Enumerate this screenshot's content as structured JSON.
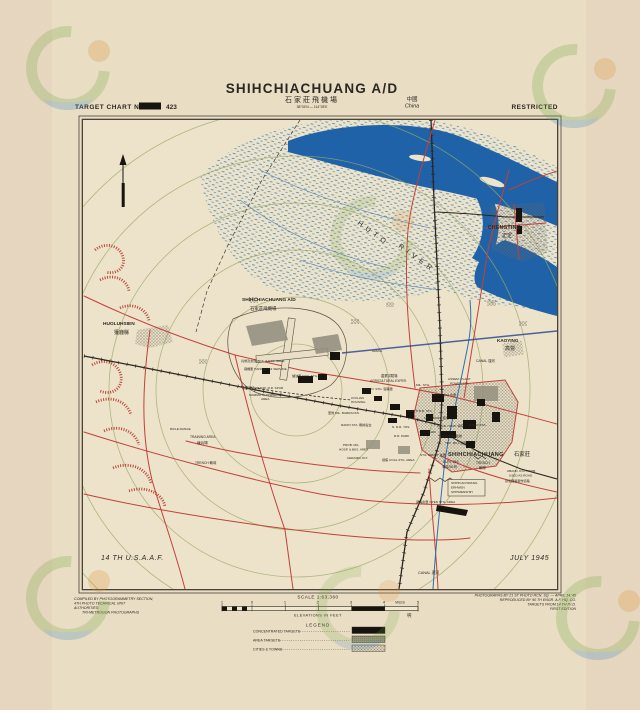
{
  "header": {
    "chart_label": "TARGET CHART No.",
    "chart_no": "423",
    "title": "SHIHCHIACHUANG A/D",
    "title_cn": "石家莊飛機場",
    "coords": "38°04'N — 114°28'E",
    "country_cn": "中國",
    "country": "China",
    "classification": "RESTRICTED"
  },
  "map": {
    "labels": [
      {
        "n": "huto-river-label-1",
        "t": "HUTO",
        "x": 357,
        "y": 224,
        "s": 7,
        "r": 36,
        "sp": 4.5
      },
      {
        "n": "huto-river-label-2",
        "t": "RIVER",
        "x": 398,
        "y": 247,
        "s": 7,
        "r": 36,
        "sp": 4.5
      },
      {
        "n": "chengting-label",
        "t": "CHENGTING",
        "x": 488,
        "y": 229,
        "s": 5,
        "b": 1,
        "sp": 0.3
      },
      {
        "n": "chengting-label-cn",
        "t": "正定",
        "x": 502,
        "y": 237,
        "s": 5
      },
      {
        "n": "kaoying-label",
        "t": "KAOYING",
        "x": 497,
        "y": 342,
        "s": 4.6,
        "b": 1
      },
      {
        "n": "kaoying-label-cn",
        "t": "高營",
        "x": 505,
        "y": 350,
        "s": 5
      },
      {
        "n": "canal-label-upper",
        "t": "CANAL 運河",
        "x": 476,
        "y": 362,
        "s": 3.4
      },
      {
        "n": "huoluhsien-label",
        "t": "HUOLUHSIEN",
        "x": 103,
        "y": 325,
        "s": 4.8,
        "b": 1
      },
      {
        "n": "huoluhsien-label-cn",
        "t": "獲鹿縣",
        "x": 114,
        "y": 334,
        "s": 5
      },
      {
        "n": "airfield-label",
        "t": "SHIHCHIACHUANG A/D",
        "x": 242,
        "y": 301,
        "s": 4.8,
        "b": 1
      },
      {
        "n": "airfield-label-cn",
        "t": "石家莊飛機場",
        "x": 250,
        "y": 310,
        "s": 4.4
      },
      {
        "n": "city-label",
        "t": "SHIHCHIACHUANG",
        "x": 448,
        "y": 456,
        "s": 5.6,
        "b": 1,
        "sp": 0.3
      },
      {
        "n": "city-label-cn",
        "t": "石家莊",
        "x": 514,
        "y": 456,
        "s": 5.4
      },
      {
        "t": "ELEV. 251'",
        "x": 443,
        "y": 463,
        "s": 3.3
      },
      {
        "t": "海拔251呎",
        "x": 442,
        "y": 468,
        "s": 3.2
      },
      {
        "t": "TRENCH",
        "x": 476,
        "y": 464,
        "s": 3.3
      },
      {
        "t": "戰壕",
        "x": 479,
        "y": 469,
        "s": 3.4
      },
      {
        "n": "usaaf-credit",
        "t": "14 TH U.S.A.A.F.",
        "x": 101,
        "y": 560,
        "s": 7,
        "i": 1,
        "sp": 0.6
      },
      {
        "n": "map-date",
        "t": "JULY 1945",
        "x": 510,
        "y": 560,
        "s": 7,
        "i": 1,
        "sp": 0.6
      },
      {
        "t": "農業試驗場",
        "x": 381,
        "y": 377,
        "s": 3.3
      },
      {
        "t": "AGRICULTURAL EXPER.",
        "x": 370,
        "y": 382,
        "s": 3.2
      },
      {
        "t": "AMMO. STG. 彈藥庫",
        "x": 364,
        "y": 390,
        "s": 3.1
      },
      {
        "t": "CIVILIAN",
        "x": 351,
        "y": 399,
        "s": 3.1
      },
      {
        "t": "HOUSING",
        "x": 351,
        "y": 403,
        "s": 3.1
      },
      {
        "t": "MIL. STG.",
        "x": 416,
        "y": 386,
        "s": 3.1
      },
      {
        "t": "ASSEM. PLANT",
        "x": 448,
        "y": 380,
        "s": 3.1
      },
      {
        "t": "POWER STA.",
        "x": 450,
        "y": 384.5,
        "s": 3.1
      },
      {
        "t": "STG. AREA 倉庫",
        "x": 433,
        "y": 396,
        "s": 3.1
      },
      {
        "t": "軍營 MIL. BARRACKS",
        "x": 328,
        "y": 414,
        "s": 3.1
      },
      {
        "t": "NORTH R.R. STA.",
        "x": 407,
        "y": 412,
        "s": 3.1
      },
      {
        "t": "RADIO STA. 無線電台",
        "x": 341,
        "y": 426,
        "s": 3.1
      },
      {
        "t": "MIL. ADMIN. 軍政",
        "x": 424,
        "y": 419,
        "s": 3.1
      },
      {
        "t": "兵營及倉庫 BKS. & STG. AREA",
        "x": 241,
        "y": 362,
        "s": 3.1
      },
      {
        "t": "飛機庫 HANGERS & SERVICE",
        "x": 244,
        "y": 370,
        "s": 3.1
      },
      {
        "t": "儲油庫 FUEL STG.",
        "x": 292,
        "y": 377,
        "s": 3.1
      },
      {
        "t": "廢棄鐵路 ABAND. R.R. SPUR",
        "x": 242,
        "y": 389,
        "s": 3.1
      },
      {
        "t": "MAMMOTH DISPERSAL",
        "x": 249,
        "y": 396,
        "s": 3.1
      },
      {
        "t": "AREA",
        "x": 261,
        "y": 400,
        "s": 3.1
      },
      {
        "t": "ADMIN.",
        "x": 372,
        "y": 352,
        "s": 3.1
      },
      {
        "t": "TRAINING AREA",
        "x": 190,
        "y": 438,
        "s": 3.3
      },
      {
        "t": "練兵場",
        "x": 197,
        "y": 444,
        "s": 3.6
      },
      {
        "t": "RIFLE RANGE",
        "x": 170,
        "y": 430,
        "s": 3.1
      },
      {
        "t": "TRENCH 戰壕",
        "x": 195,
        "y": 464,
        "s": 3.3
      },
      {
        "t": "PROB. MIL.",
        "x": 343,
        "y": 446,
        "s": 3.1
      },
      {
        "t": "HOSP. & BKS. AREA",
        "x": 339,
        "y": 450.5,
        "s": 3.1
      },
      {
        "t": "CERAMIC PLT.",
        "x": 347,
        "y": 459,
        "s": 3.1
      },
      {
        "t": "煉焦 COAL STG. AREA",
        "x": 382,
        "y": 461,
        "s": 3.1
      },
      {
        "t": "STG. DEPOT 倉庫",
        "x": 420,
        "y": 456,
        "s": 3.1
      },
      {
        "t": "PROB. HOSP. 病院",
        "x": 437,
        "y": 427,
        "s": 3.1
      },
      {
        "t": "RADIO STA.",
        "x": 469,
        "y": 426,
        "s": 3.1
      },
      {
        "t": "PRISON 監獄",
        "x": 443,
        "y": 437,
        "s": 3.1
      },
      {
        "t": "PARK",
        "x": 428,
        "y": 433,
        "s": 3.1
      },
      {
        "t": "TEX. MILL 織廠",
        "x": 445,
        "y": 444,
        "s": 3.1
      },
      {
        "t": "N. R.R. YDS.",
        "x": 392,
        "y": 428,
        "s": 3.1
      },
      {
        "t": "R.R. PARK",
        "x": 394,
        "y": 437,
        "s": 3.1
      },
      {
        "n": "alt-name-1",
        "t": "SHIHKIACHWANG",
        "x": 451,
        "y": 484,
        "s": 3.1
      },
      {
        "n": "alt-name-2",
        "t": "ERHWEN",
        "x": 451,
        "y": 488.5,
        "s": 3.1
      },
      {
        "n": "alt-name-3",
        "t": "SHIHMENSHIH",
        "x": 451,
        "y": 493,
        "s": 3.1
      },
      {
        "t": "ABAND. R.R. PROB.",
        "x": 507,
        "y": 472,
        "s": 3.1
      },
      {
        "t": "USED AS ROAD",
        "x": 509,
        "y": 476.5,
        "s": 3.1
      },
      {
        "t": "廢棄鐵路現作道路",
        "x": 505,
        "y": 482,
        "s": 3.1
      },
      {
        "t": "露天倉庫 OPEN STG. AREA",
        "x": 416,
        "y": 503,
        "s": 3.1
      },
      {
        "n": "canal-label-lower",
        "t": "CANAL 運河",
        "x": 418,
        "y": 574,
        "s": 3.8
      }
    ]
  },
  "footer": {
    "compiled": [
      "COMPILED BY PHOTOGRAMMETRY SECTION,",
      "4TH PHOTO TECHNICAL UNIT",
      "AUTHORITIES:",
      "TRI-METROGON PHOTOGRAPHS"
    ],
    "photo": [
      "PHOTOGRAPHS BY 21 ST PHOTO RCN. SQ. — APRIL 14,'45",
      "REPRODUCED BY 90 TH ENGR. A.F. HQ. CO.",
      "TARGETS FROM 14 TH P.I.D.",
      "FIRST EDITION"
    ],
    "scale_label": "SCALE 1:63,360",
    "scale_ticks": [
      "1",
      "0",
      "1",
      "2",
      "3",
      "4",
      "5"
    ],
    "scale_miles": "MILES",
    "elevations": "ELEVATIONS IN FEET",
    "elevations_cn": "呎",
    "legend_title": "LEGEND",
    "legend": [
      {
        "label": "CONCENTRATED TARGETS",
        "swatch": "solid-black"
      },
      {
        "label": "AREA TARGETS",
        "swatch": "solid-gray"
      },
      {
        "label": "CITIES & TOWNS",
        "swatch": "crosshatch"
      }
    ]
  },
  "colors": {
    "paper": "#e9ddc4",
    "road_red": "#c2403a",
    "river_blue": "#1f62a8",
    "ring_olive": "#9aa968",
    "target_black": "#17140f",
    "ridge_red": "#b43429",
    "pencil_blue": "#24408f"
  }
}
